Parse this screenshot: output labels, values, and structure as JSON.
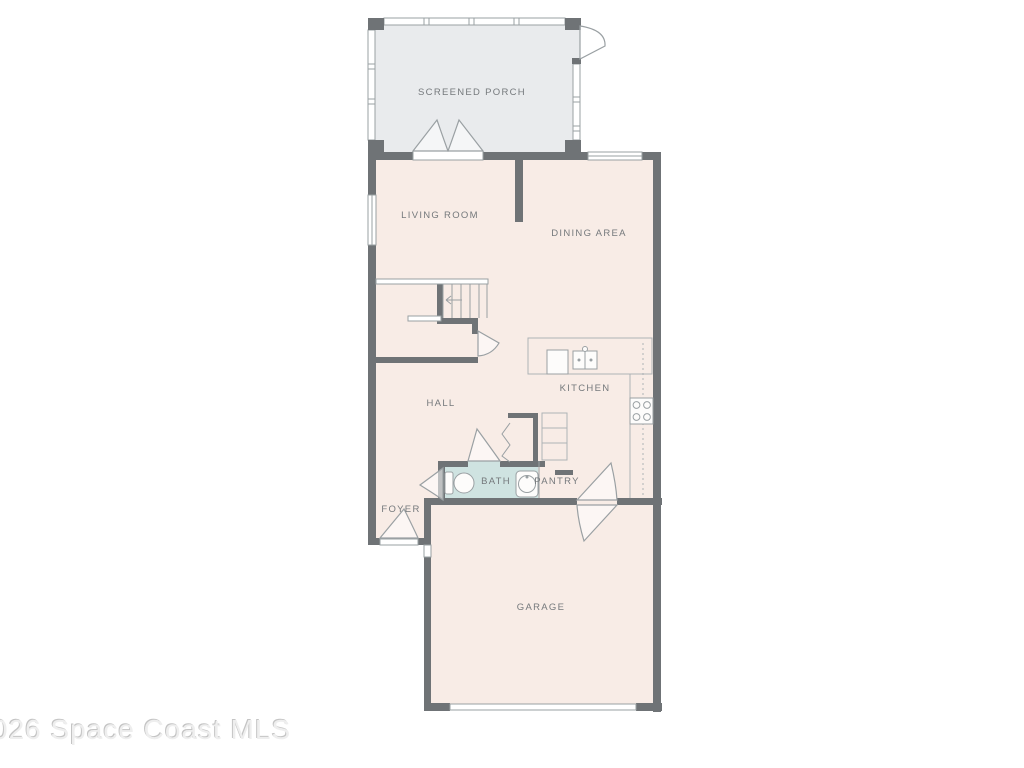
{
  "watermark": {
    "text": "026 Space Coast MLS"
  },
  "rooms": {
    "screened_porch": "SCREENED PORCH",
    "living_room": "LIVING ROOM",
    "dining_area": "DINING AREA",
    "kitchen": "KITCHEN",
    "hall": "HALL",
    "bath": "BATH",
    "pantry": "PANTRY",
    "foyer": "FOYER",
    "garage": "GARAGE"
  },
  "colors": {
    "wall": "#6f7376",
    "floor": "#f8ece6",
    "porch": "#e9ebed",
    "bath": "#cfe3e1",
    "line": "#9aa0a3",
    "line2": "#aeb3b6",
    "label": "#75797c"
  }
}
